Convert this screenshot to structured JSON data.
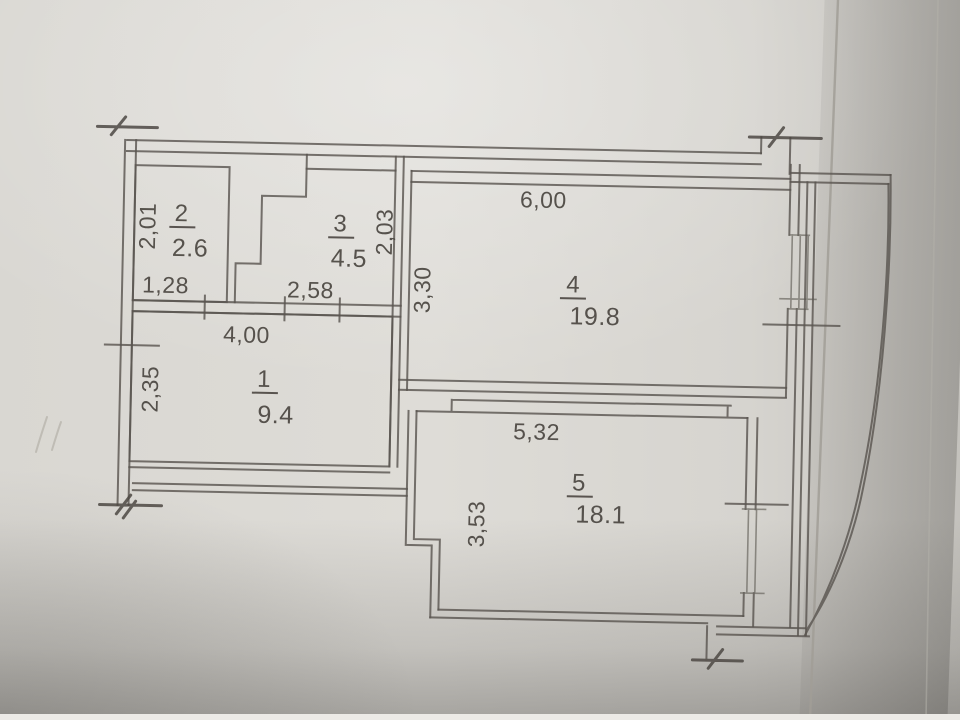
{
  "plan": {
    "rooms": [
      {
        "number": "1",
        "area": "9.4",
        "width_dim": "4,00",
        "height_dim": "2,35"
      },
      {
        "number": "2",
        "area": "2.6",
        "width_dim": "1,28",
        "height_dim": "2,01"
      },
      {
        "number": "3",
        "area": "4.5",
        "width_dim": "2,58",
        "height_dim": "2,03"
      },
      {
        "number": "4",
        "area": "19.8",
        "width_dim": "6,00",
        "height_dim": "3,30"
      },
      {
        "number": "5",
        "area": "18.1",
        "width_dim": "5,32",
        "height_dim": "3,53"
      }
    ]
  },
  "colors": {
    "paper": "#d6d4cf",
    "ink": "#5a5651",
    "text": "#4a4540",
    "crease": "#a19e97"
  }
}
